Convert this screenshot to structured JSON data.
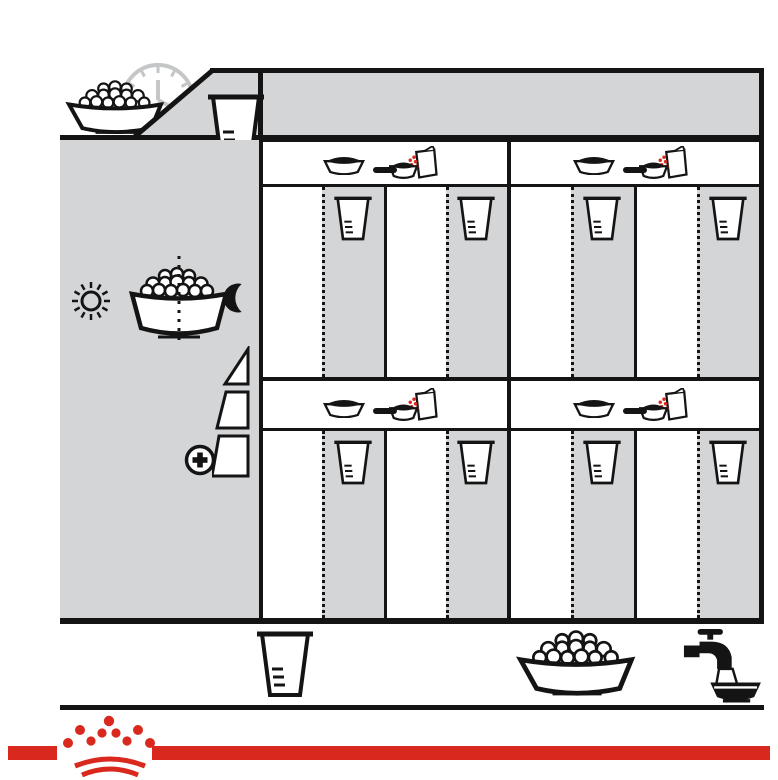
{
  "title": "РЕКОМЕНДАЦИИ ПО КОРМЛЕНИЮ",
  "header": {
    "daily_label": "24 ч",
    "weight_title": "Вес собаки"
  },
  "sidebar": {
    "vertical_label": "УРОВЕНЬ АКТИВНОСТИ",
    "bowl_half_left": "½",
    "bowl_half_right": "½",
    "normal_label": "Нормальный",
    "high_label": "Высокий"
  },
  "table": {
    "or_label": "или",
    "grams_header": "(г)",
    "groups": [
      {
        "weight": "1 кг",
        "extra": "+1/2",
        "dry": {
          "grams": [
            "24",
            "27",
            "31"
          ],
          "cups": [
            "2/8",
            "2/8",
            "2/8"
          ]
        },
        "mixed": {
          "grams": [
            "13",
            "16",
            "20"
          ],
          "cups": [
            "1/8",
            "1/8",
            "1/8"
          ]
        }
      },
      {
        "weight": "3 кг",
        "extra": "+1",
        "dry": {
          "grams": [
            "54",
            "63",
            "71"
          ],
          "cups": [
            "4/8",
            "5/8",
            "5/8"
          ]
        },
        "mixed": {
          "grams": [
            "32",
            "40",
            "49"
          ],
          "cups": [
            "2/8",
            "3/8",
            "4/8"
          ]
        }
      },
      {
        "weight": "6 кг",
        "extra": "+1",
        "dry": {
          "grams": [
            "91",
            "105",
            "120"
          ],
          "cups": [
            "7/8",
            "1",
            "1+1/8"
          ]
        },
        "mixed": {
          "grams": [
            "69",
            "83",
            "97"
          ],
          "cups": [
            "5/8",
            "6/8",
            "7/8"
          ]
        }
      },
      {
        "weight": "10 кг",
        "extra": "+1",
        "dry": {
          "grams": [
            "133",
            "154",
            "175"
          ],
          "cups": [
            "1+2/8",
            "1+3/8",
            "1+5/8"
          ]
        },
        "mixed": {
          "grams": [
            "111",
            "132",
            "153"
          ],
          "cups": [
            "1",
            "1+2/8",
            "1+3/8"
          ]
        }
      }
    ]
  },
  "footer": {
    "energy_line1": "Обменная энергия",
    "energy_line2": "= 4008 ккал/кг",
    "cup_label": "СТАКАН",
    "cup_equivalence": "= 240 мл (≃108 г)",
    "plus_sign": "+"
  },
  "colors": {
    "red": "#d9291e",
    "gray": "#d3d5d7",
    "ink": "#141414",
    "clock": "#c4c6c8"
  }
}
